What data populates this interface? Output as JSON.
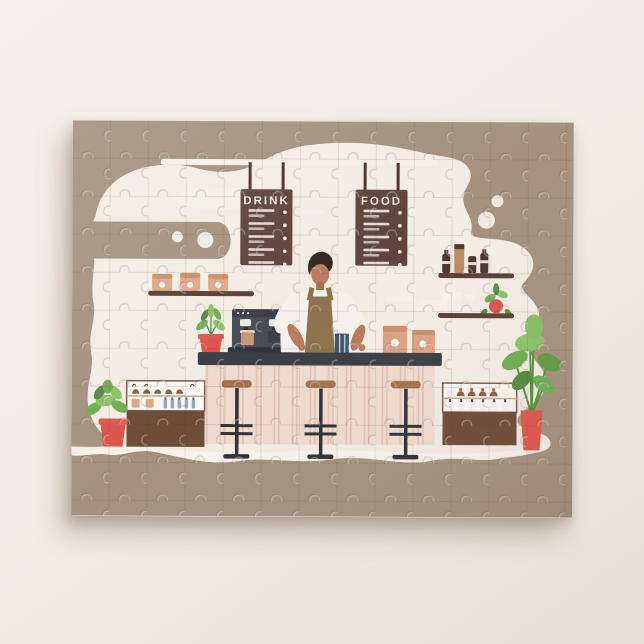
{
  "scene": {
    "description": "Jigsaw puzzle with a flat-style coffee shop illustration: a barista behind a counter, hanging menu boards, espresso machine, bar stools, shelves and plants"
  },
  "puzzle": {
    "menu_boards": {
      "drink_label": "DRINK",
      "food_label": "FOOD"
    },
    "colors": {
      "background_brown": "#a5917e",
      "wall_cream": "#f3ece3",
      "floor_cream": "#f8f3ec",
      "rail_cream": "#f6f0e7",
      "board_brown": "#5e443c",
      "shelf_brown": "#5b4033",
      "bag_tan": "#dfa88a",
      "machine_gray": "#474c55",
      "counter_top": "#3b3e46",
      "counter_front": "#efdacd",
      "stool_seat": "#a5714b",
      "stool_metal": "#2e3136",
      "case_base_brown": "#6d4c38",
      "skin": "#b97c5a",
      "hair": "#322820",
      "shirt": "#f6f1ea",
      "apron": "#8e744e",
      "press_navy": "#41536e",
      "accent_red": "#dd534b",
      "leaf_green": "#6fae52",
      "leaf_green_dark": "#548c3f"
    }
  }
}
